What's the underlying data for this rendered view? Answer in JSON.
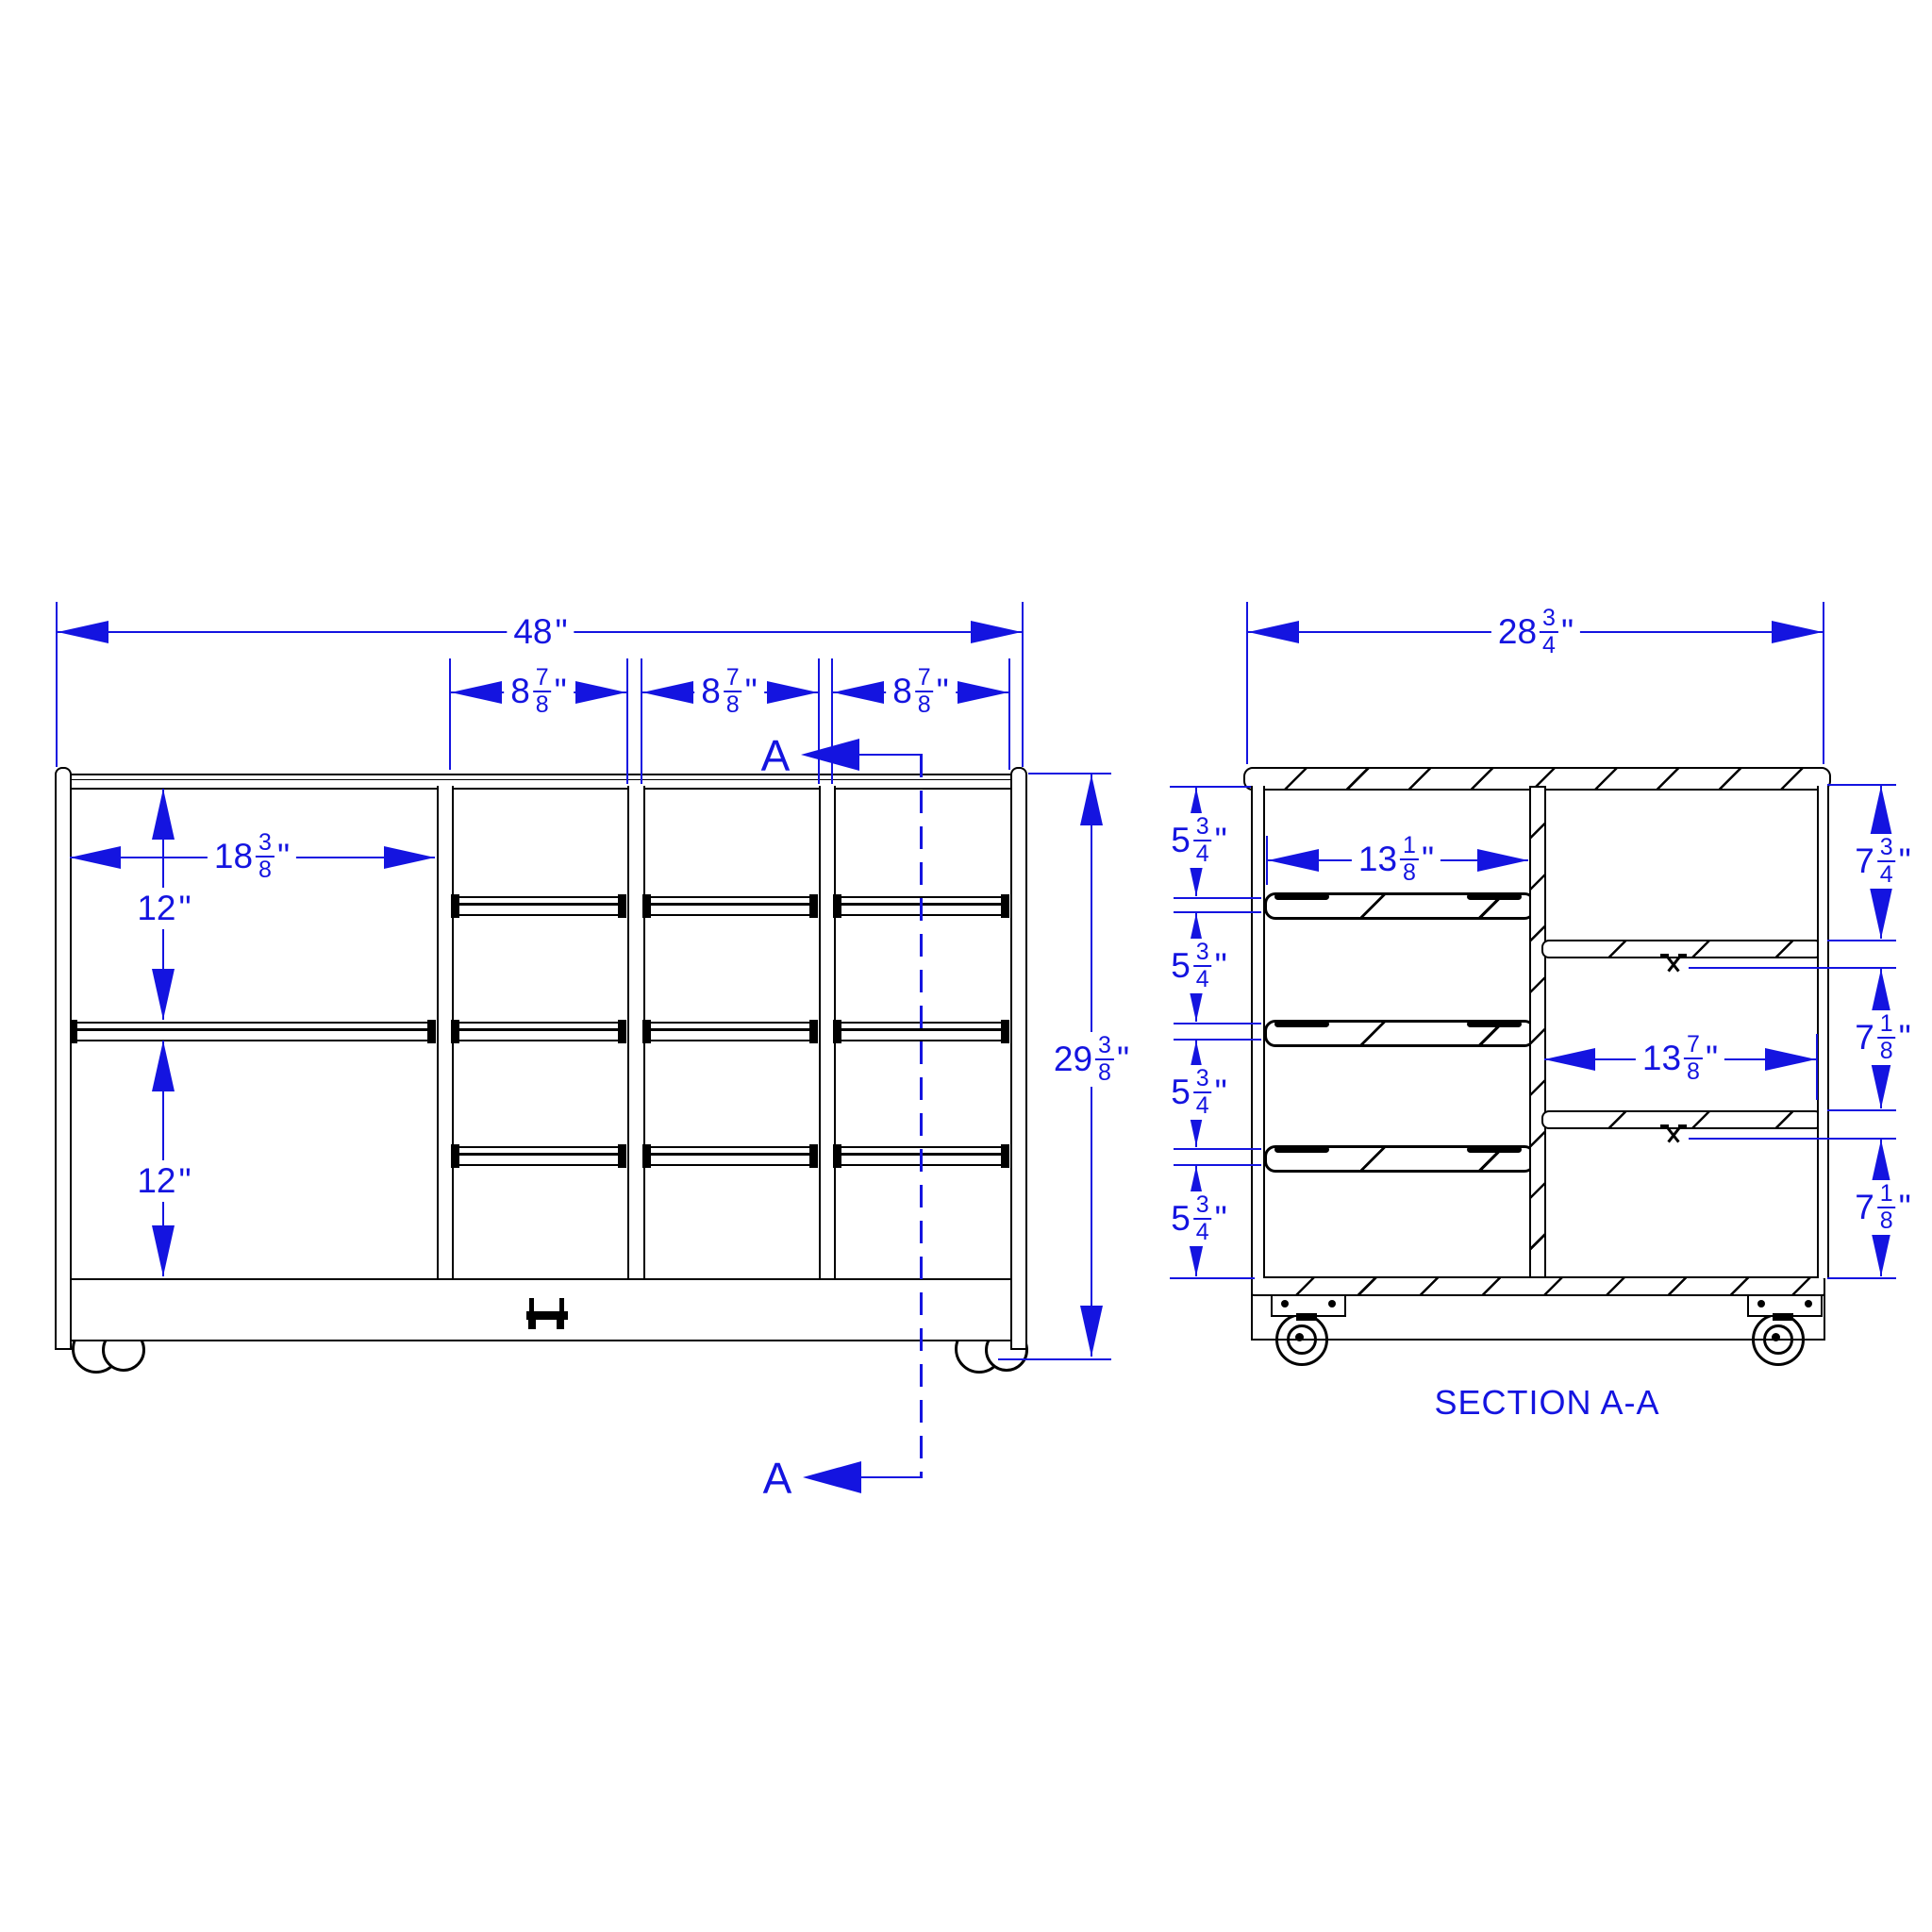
{
  "colors": {
    "dimension": "#1414e0",
    "geometry": "#000000",
    "background": "#ffffff"
  },
  "front": {
    "marker_letter": "A",
    "dim_overall_width": {
      "int": "48",
      "unit": "\""
    },
    "dim_column_width": {
      "int": "8",
      "num": "7",
      "den": "8",
      "unit": "\""
    },
    "dim_left_opening_width": {
      "int": "18",
      "num": "3",
      "den": "8",
      "unit": "\""
    },
    "dim_shelf_spacing": {
      "int": "12",
      "unit": "\""
    },
    "dim_overall_height": {
      "int": "29",
      "num": "3",
      "den": "8",
      "unit": "\""
    }
  },
  "section": {
    "title": "SECTION A-A",
    "dim_overall_depth": {
      "int": "28",
      "num": "3",
      "den": "4",
      "unit": "\""
    },
    "dim_tote_row_spacing": {
      "int": "5",
      "num": "3",
      "den": "4",
      "unit": "\""
    },
    "dim_tote_shelf_depth": {
      "int": "13",
      "num": "1",
      "den": "8",
      "unit": "\""
    },
    "dim_right_shelf_depth": {
      "int": "13",
      "num": "7",
      "den": "8",
      "unit": "\""
    },
    "dim_top_shelf_clearance": {
      "int": "7",
      "num": "3",
      "den": "4",
      "unit": "\""
    },
    "dim_shelf_clearance": {
      "int": "7",
      "num": "1",
      "den": "8",
      "unit": "\""
    }
  }
}
